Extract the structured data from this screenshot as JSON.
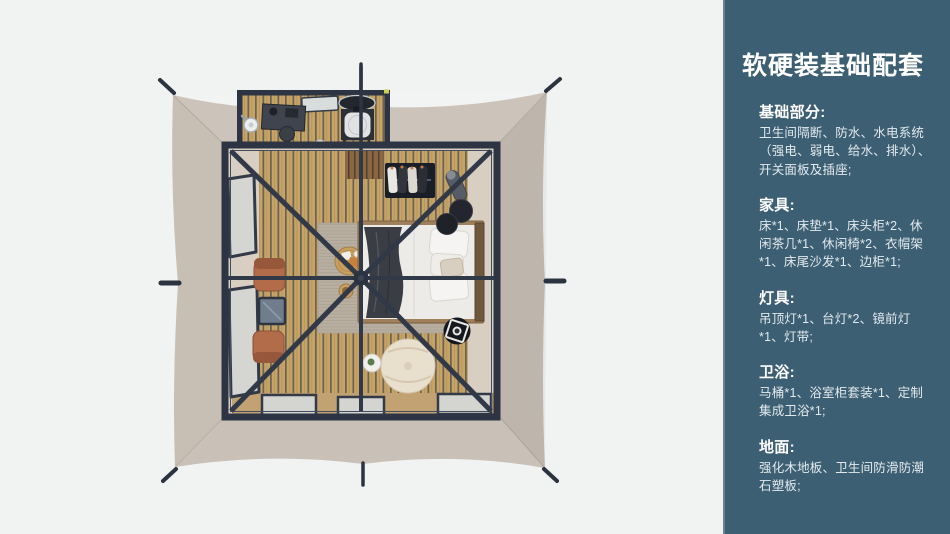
{
  "colors": {
    "page_bg": "#f1f2f2",
    "panel_bg": "#3d5f73",
    "tarp": "#c7beb4",
    "frame": "#2d3443",
    "wood_floor": "#c6a367",
    "terracotta_chair": "#b26c4a",
    "accent_dot": "#c9d24b"
  },
  "panel": {
    "title": "软硬装基础配套",
    "sections": [
      {
        "heading": "基础部分:",
        "body": "卫生间隔断、防水、水电系统（强电、弱电、给水、排水）、开关面板及插座;"
      },
      {
        "heading": "家具:",
        "body": "床*1、床垫*1、床头柜*2、休闲茶几*1、休闲椅*2、衣帽架*1、床尾沙发*1、边柜*1;"
      },
      {
        "heading": "灯具:",
        "body": "吊顶灯*1、台灯*2、镜前灯*1、灯带;"
      },
      {
        "heading": "卫浴:",
        "body": "马桶*1、浴室柜套装*1、定制集成卫浴*1;"
      },
      {
        "heading": "地面:",
        "body": "强化木地板、卫生间防滑防潮石塑板;"
      }
    ]
  },
  "illustration": {
    "description": "top-down rendering of square safari tent with bedroom and bathroom annex"
  }
}
